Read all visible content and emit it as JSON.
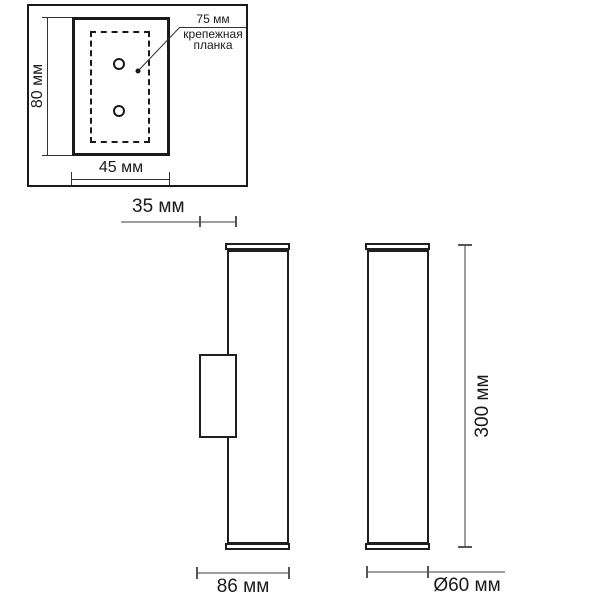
{
  "colors": {
    "background": "#ffffff",
    "drawing_line": "#1a1a1a",
    "dimension_line": "#9e9e9e",
    "dimension_tick": "#555555",
    "text": "#1a1a1a"
  },
  "plate_view": {
    "height_dim": "80 мм",
    "width_dim": "45 мм",
    "holes_dim": "75 мм",
    "mount_label_line1": "крепежная",
    "mount_label_line2": "планка"
  },
  "side_view": {
    "offset_dim": "35 мм",
    "depth_dim": "86 мм"
  },
  "front_view": {
    "height_dim": "300 мм",
    "diameter_dim": "Ø60 мм"
  }
}
